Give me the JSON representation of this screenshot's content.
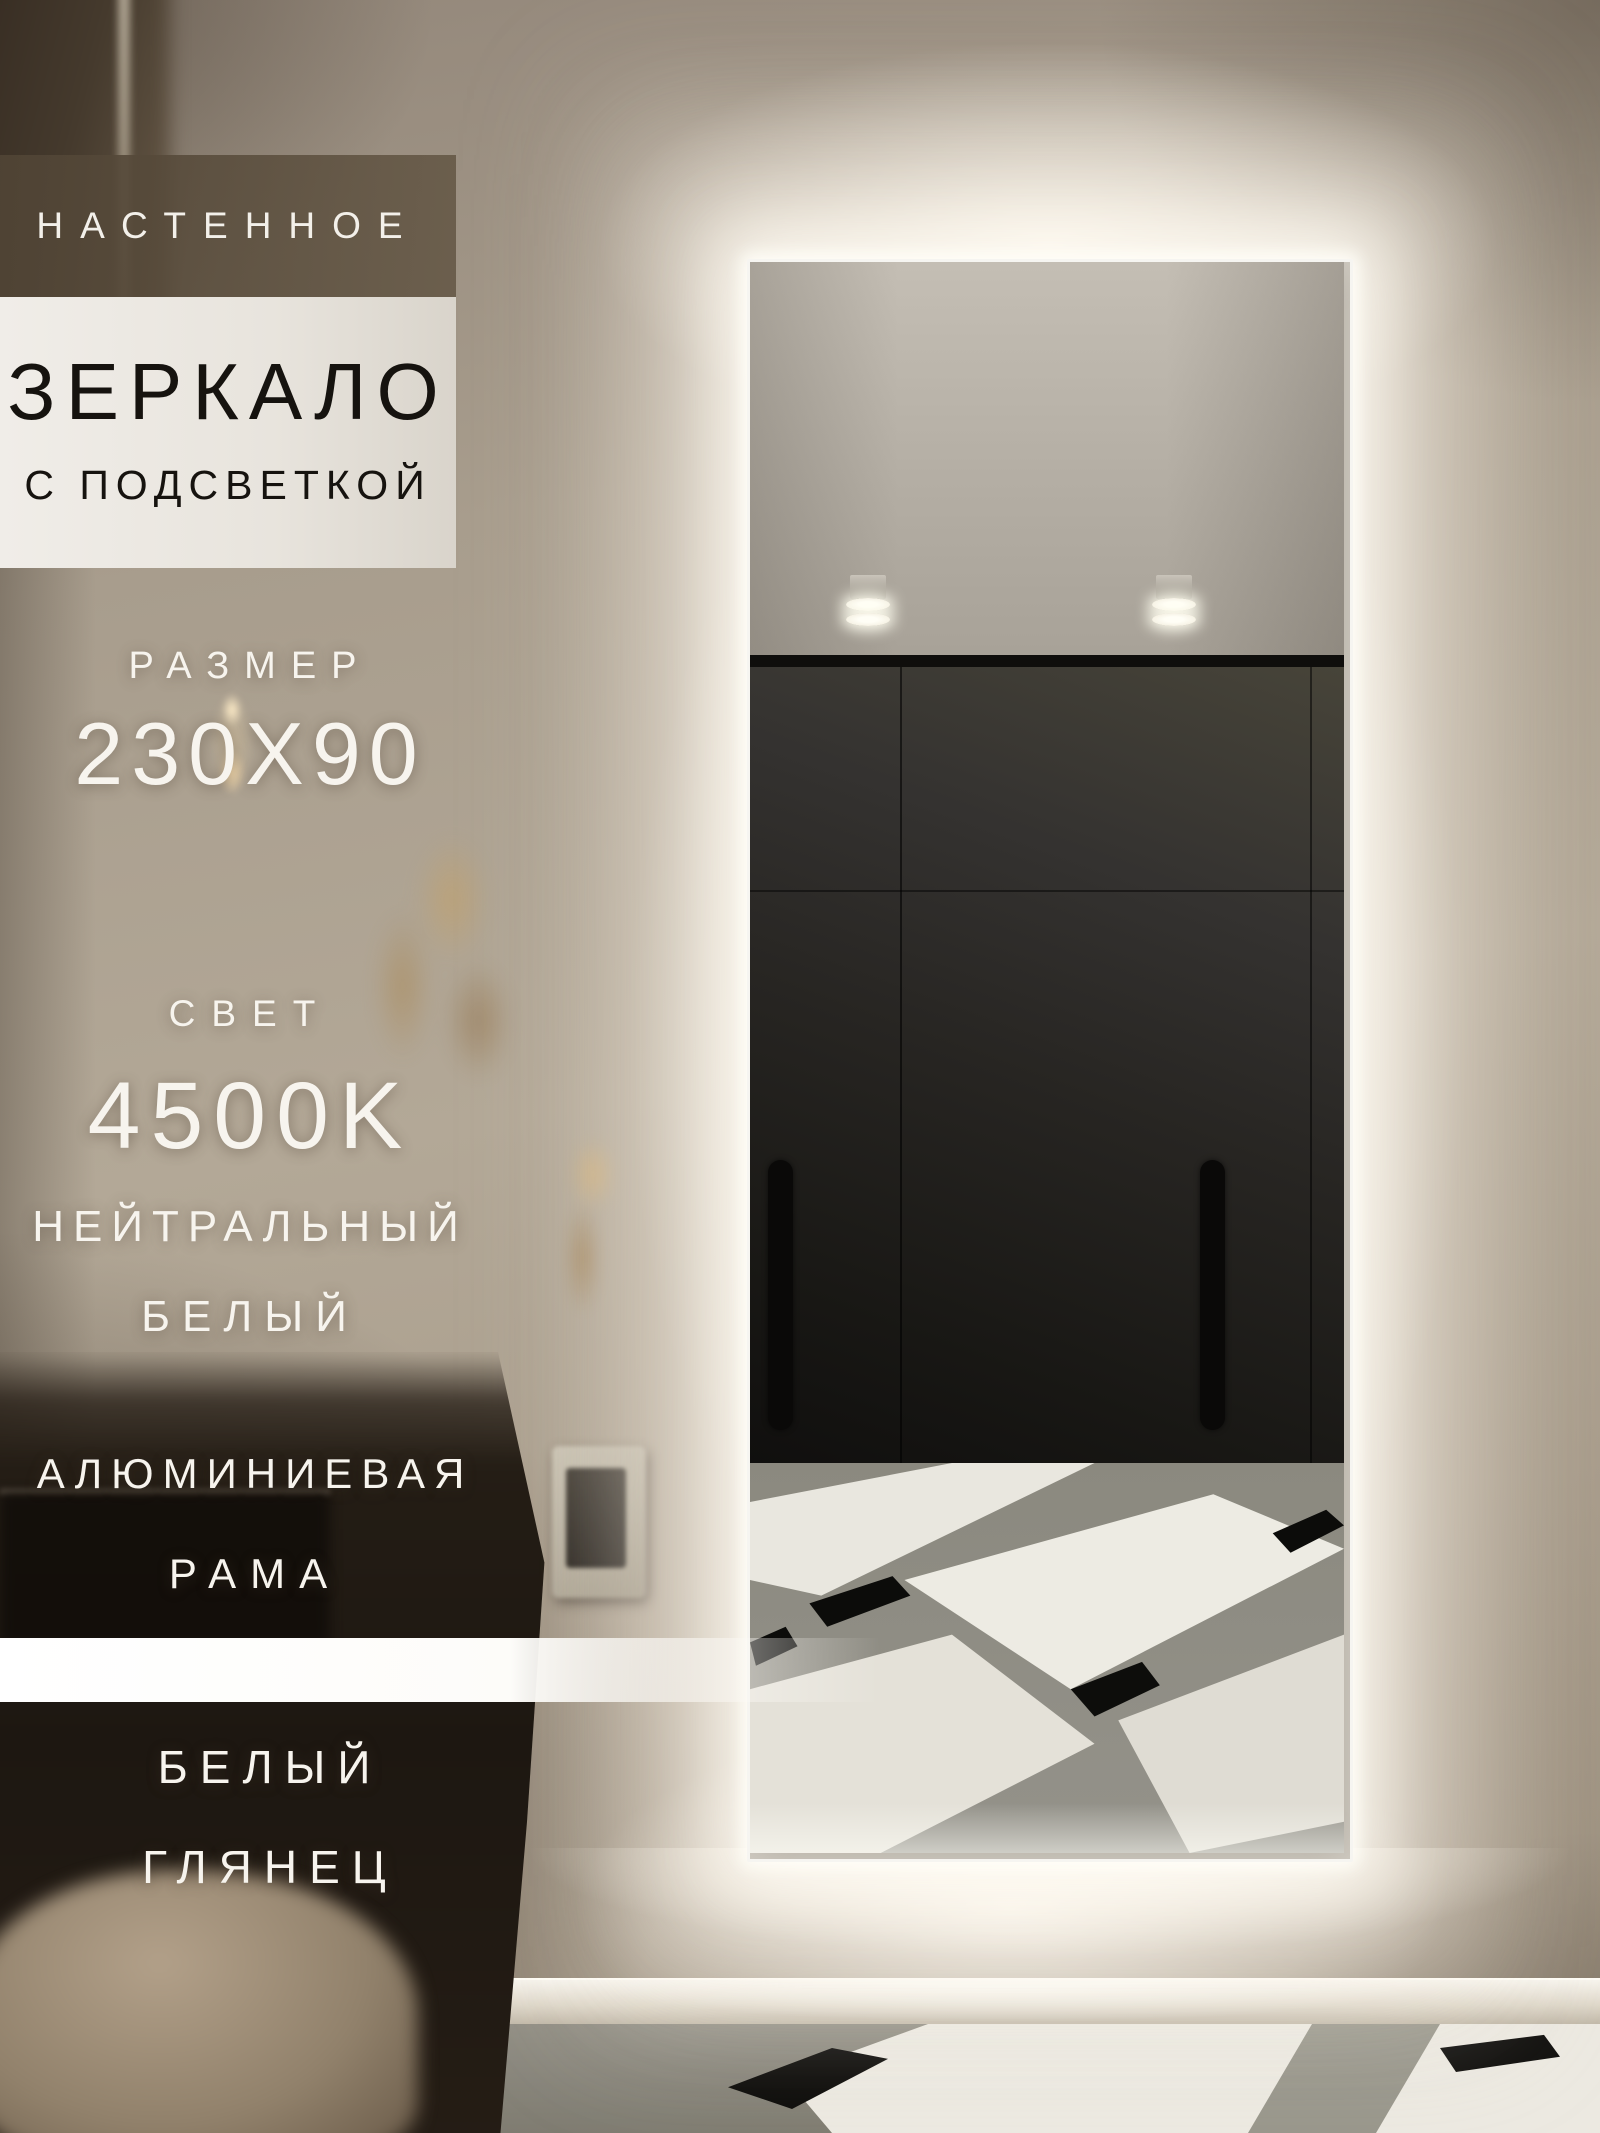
{
  "brand": {
    "name": "ALUMIRROR"
  },
  "overlays": {
    "wall_type": "НАСТЕННОЕ",
    "product": "ЗЕРКАЛО",
    "backlight": "С ПОДСВЕТКОЙ",
    "size_label": "РАЗМЕР",
    "size_value": "230X90",
    "light_label": "СВЕТ",
    "light_value": "4500K",
    "light_tone_1": "НЕЙТРАЛЬНЫЙ",
    "light_tone_2": "БЕЛЫЙ",
    "frame_1": "АЛЮМИНИЕВАЯ",
    "frame_2": "РАМА",
    "finish_1": "БЕЛЫЙ",
    "finish_2": "ГЛЯНЕЦ"
  },
  "colors": {
    "led_glow": "#fff9ee",
    "wall": "#b3a897",
    "dark_band": "#584c3e",
    "light_band": "#ebe8e2",
    "wardrobe_reflection": "#23211e",
    "marble_white": "#edebe3",
    "marble_black": "#0d0d0b",
    "text_light": "#f7f4ee",
    "text_dark": "#16130f"
  }
}
